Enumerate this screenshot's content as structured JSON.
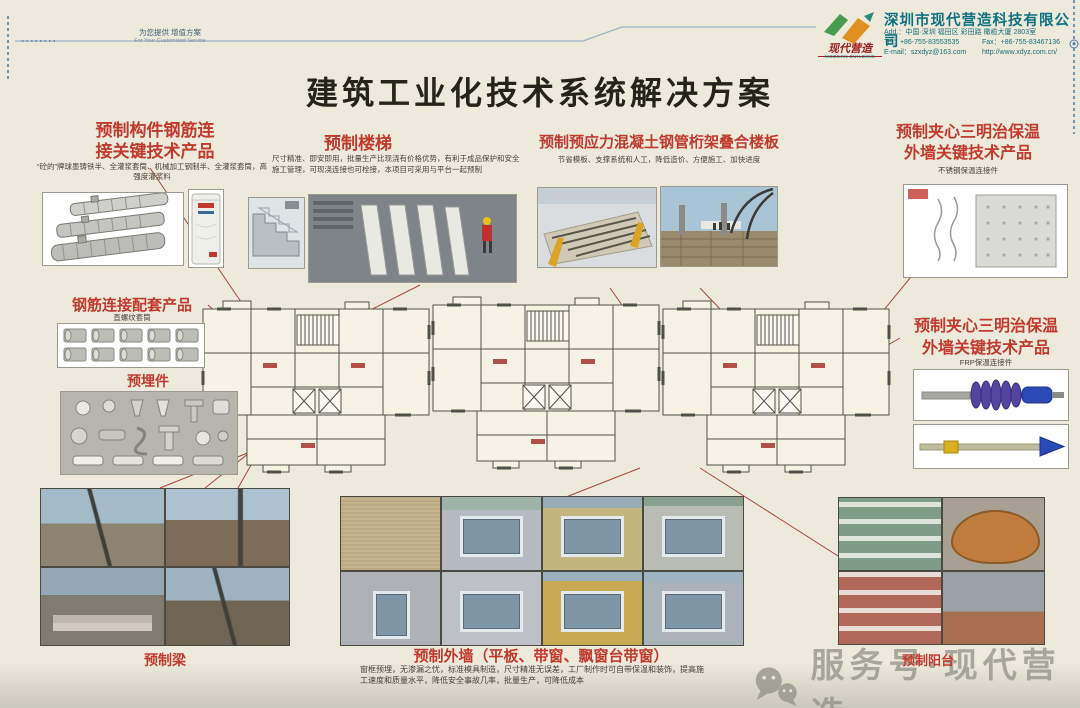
{
  "brand_colors": {
    "heading_red": "#c13a2e",
    "company_teal": "#0e7180",
    "logo_green": "#4a9a50",
    "logo_orange": "#e09020",
    "connector_line_red": "#a8473a",
    "page_background": "#edeadb"
  },
  "header": {
    "tagline_cn": "为您提供 增值方案",
    "tagline_en": "For Your Customized Service"
  },
  "company": {
    "logo_text": "现代营造",
    "logo_sub": "MODERN BUILDING",
    "name": "深圳市现代营造科技有限公司",
    "address": "Add.：中国·深圳 福田区 彩田路 橄榄大厦 2803室",
    "tel": "Tel：+86-755-83553535",
    "fax": "Fax：+86-755-83467136",
    "email": "E-mail：szxdyz@163.com",
    "website": "http://www.xdyz.com.cn/"
  },
  "page": {
    "title": "建筑工业化技术系统解决方案"
  },
  "sections": {
    "rebar": {
      "title_line1": "预制构件钢筋连",
      "title_line2": "接关键技术产品",
      "desc": "“砼的”牌球墨铸铁半、全灌浆套筒、机械加工钢制半、全灌浆套筒，高强度灌浆料"
    },
    "stairs": {
      "title": "预制楼梯",
      "desc": "尺寸精准、即安即用，批量生产比现浇有价格优势，有利于成品保护和安全施工管理，可现浇连接也可栓接，本项目可采用与平台一起预制"
    },
    "slab": {
      "title": "预制预应力混凝土钢管桁架叠合楼板",
      "desc": "节省模板、支撑系统和人工，降低造价、方便施工、加快进度"
    },
    "sandwich_top": {
      "title_line1": "预制夹心三明治保温",
      "title_line2": "外墙关键技术产品",
      "desc": "不锈钢保温连接件"
    },
    "coupler": {
      "title": "钢筋连接配套产品",
      "desc": "直螺纹套筒"
    },
    "embedded": {
      "title": "预埋件"
    },
    "sandwich_right": {
      "title_line1": "预制夹心三明治保温",
      "title_line2": "外墙关键技术产品",
      "desc": "FRP保温连接件"
    },
    "beam": {
      "title": "预制梁"
    },
    "exterior_wall": {
      "title": "预制外墙（平板、带窗、飘窗台带窗）",
      "desc": "窗框预埋，无渗漏之忧，标准模具制造，尺寸精准无误差，工厂制作时可自带保温和装饰，提高施工速度和质量水平，降低安全事故几率，批量生产，可降低成本"
    },
    "balcony": {
      "title": "预制阳台"
    }
  },
  "watermark": {
    "text": "服务号·现代营造"
  }
}
